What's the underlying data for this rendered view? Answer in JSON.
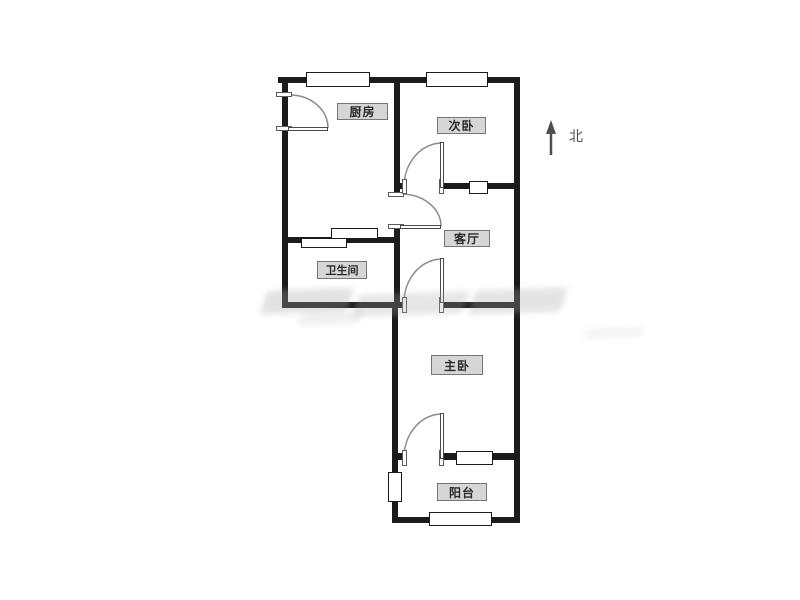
{
  "floorplan": {
    "rooms": [
      {
        "name": "kitchen",
        "label": "厨房"
      },
      {
        "name": "secondary-bedroom",
        "label": "次卧"
      },
      {
        "name": "living-room",
        "label": "客厅"
      },
      {
        "name": "bathroom",
        "label": "卫生间"
      },
      {
        "name": "master-bedroom",
        "label": "主卧"
      },
      {
        "name": "balcony",
        "label": "阳台"
      }
    ],
    "compass": {
      "label": "北"
    },
    "colors": {
      "wall": "#1b1b1b",
      "label_bg": "#d6d6d6",
      "label_border": "#767676",
      "label_text": "#2a2a2a",
      "door_arc": "#8a8a8a",
      "north_arrow": "#4f4f4f"
    }
  }
}
